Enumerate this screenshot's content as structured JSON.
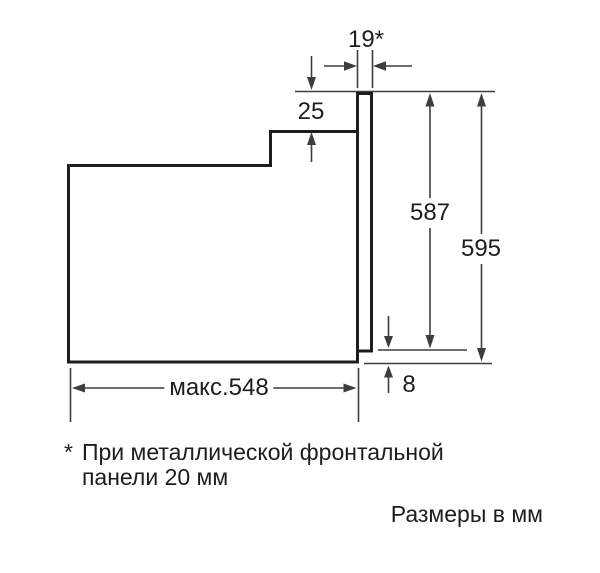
{
  "diagram": {
    "type": "oven-installation-dimension-drawing",
    "dimensions": {
      "front_panel_thickness": "19*",
      "top_step": "25",
      "panel_height": "587",
      "total_height": "595",
      "bottom_offset": "8",
      "max_depth": "макс.548"
    },
    "footnote": {
      "marker": "*",
      "line1": "При металлической фронтальной",
      "line2": "панели 20 мм"
    },
    "units_note": "Размеры в мм",
    "colors": {
      "outline": "#1d1d1b",
      "dimension_lines": "#3d3d3d",
      "text": "#1d1d1b",
      "background": "#ffffff"
    }
  }
}
